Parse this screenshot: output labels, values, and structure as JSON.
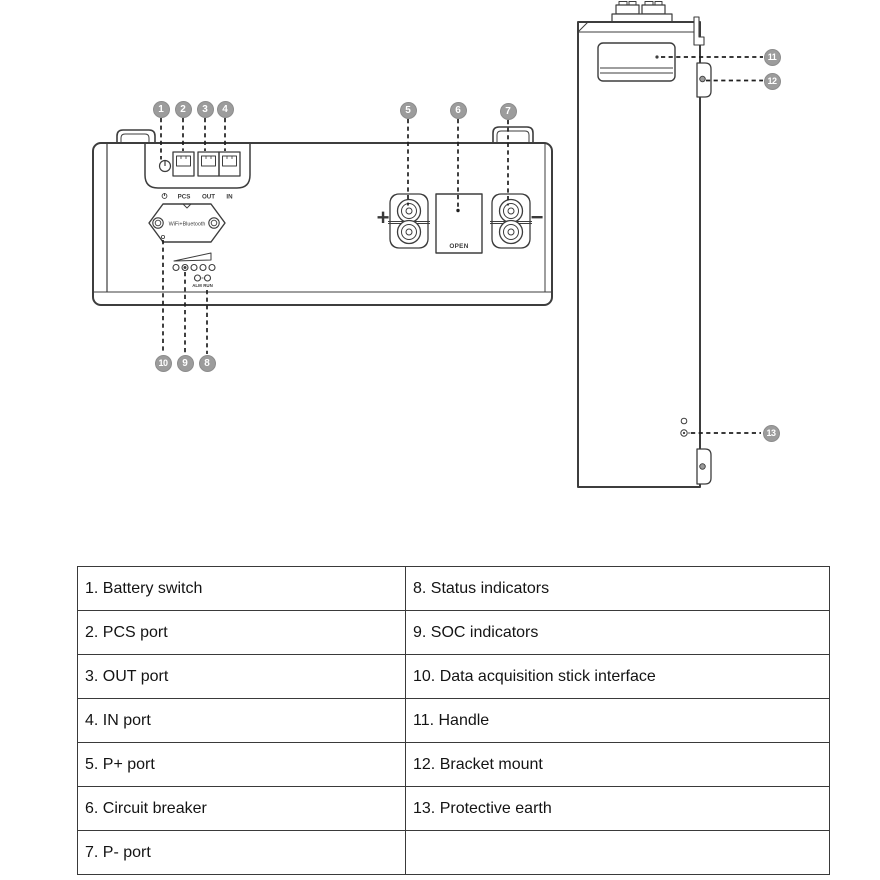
{
  "colors": {
    "line": "#3d3d3d",
    "callout_badge": "#9c9c9c",
    "table_border": "#3a3a3a"
  },
  "front_view": {
    "port_labels": {
      "pcs": "PCS",
      "out": "OUT",
      "in": "IN"
    },
    "wifi_label": "WiFi+Bluetooth",
    "breaker_label": "OPEN",
    "status_labels": {
      "alm": "ALM",
      "run": "RUN"
    },
    "polarity": {
      "plus": "+",
      "minus": "−"
    }
  },
  "callouts": [
    {
      "num": "1"
    },
    {
      "num": "2"
    },
    {
      "num": "3"
    },
    {
      "num": "4"
    },
    {
      "num": "5"
    },
    {
      "num": "6"
    },
    {
      "num": "7"
    },
    {
      "num": "8"
    },
    {
      "num": "9"
    },
    {
      "num": "10"
    },
    {
      "num": "11"
    },
    {
      "num": "12"
    },
    {
      "num": "13"
    }
  ],
  "legend_table": {
    "rows": [
      {
        "left": "1. Battery switch",
        "right": "8. Status indicators"
      },
      {
        "left": "2. PCS port",
        "right": "9. SOC indicators"
      },
      {
        "left": "3. OUT port",
        "right": "10. Data acquisition stick interface"
      },
      {
        "left": "4. IN port",
        "right": "11. Handle"
      },
      {
        "left": "5. P+ port",
        "right": "12. Bracket mount"
      },
      {
        "left": "6. Circuit breaker",
        "right": "13. Protective earth"
      },
      {
        "left": "7. P- port",
        "right": ""
      }
    ]
  }
}
